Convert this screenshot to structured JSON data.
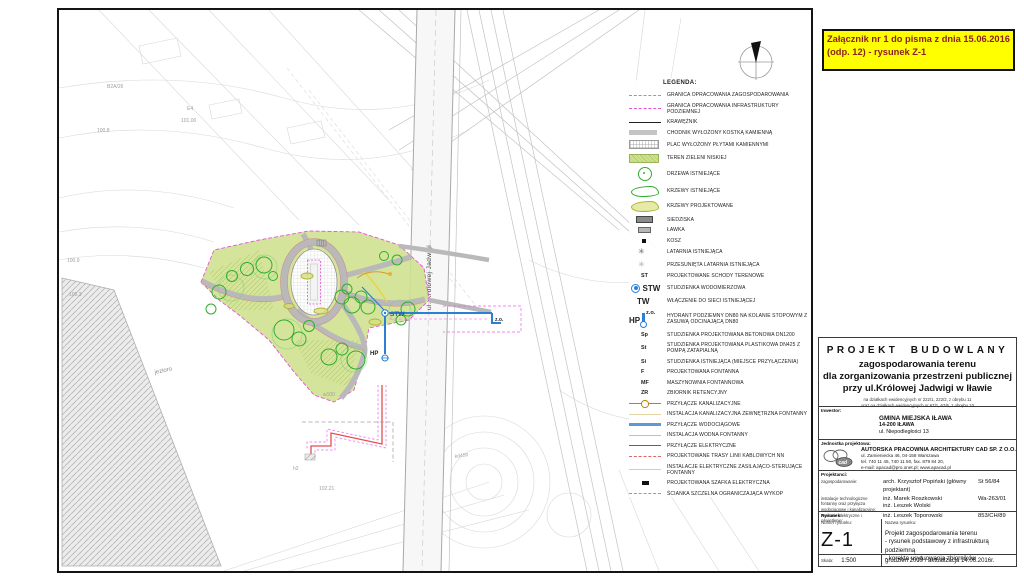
{
  "note": {
    "line1": "Załącznik nr 1 do pisma z dnia 15.06.2016",
    "line2": "(odp. 12) - rysunek Z-1"
  },
  "colors": {
    "note_bg": "#ffff00",
    "note_text": "#8b1e1e",
    "park_green": "#cfe08d",
    "boundary_magenta": "#e454d8",
    "water_blue": "#2b7fd4",
    "electric_red": "#e03030",
    "fountain_yellow": "#f1d738"
  },
  "map": {
    "road_label": "ul. Królowej Jadwigi",
    "lake_label": "jezioro",
    "markers": {
      "stw": "STW",
      "zo": "z.o.",
      "hp": "HP"
    },
    "labels": [
      "E4",
      "101.00",
      "B2A/26",
      "102.21",
      "h2",
      "w100",
      "kd450",
      "100.8",
      "100.3",
      "100.9"
    ]
  },
  "legend": {
    "title": "LEGENDA:",
    "items": [
      {
        "label": "GRANICA OPRACOWANIA ZAGOSPODAROWANIA"
      },
      {
        "label": "GRANICA OPRACOWANIA INFRASTRUKTURY PODZIEMNEJ"
      },
      {
        "label": "KRAWĘŻNIK"
      },
      {
        "label": "CHODNIK WYŁOŻONY KOSTKĄ KAMIENNĄ"
      },
      {
        "label": "PLAC WYŁOŻONY PŁYTAMI KAMIENNYMI"
      },
      {
        "label": "TEREN ZIELENI NISKIEJ"
      },
      {
        "label": "DRZEWA ISTNIEJĄCE"
      },
      {
        "label": "KRZEWY ISTNIEJĄCE"
      },
      {
        "label": "KRZEWY PROJEKTOWANE"
      },
      {
        "label": "SIEDZISKA"
      },
      {
        "label": "ŁAWKA"
      },
      {
        "label": "KOSZ"
      },
      {
        "label": "LATARNIA ISTNIEJĄCA"
      },
      {
        "label": "PRZESUNIĘTA LATARNIA ISTNIEJĄCA"
      },
      {
        "code": "ST",
        "label": "PROJEKTOWANE SCHODY TERENOWE"
      },
      {
        "code": "STW",
        "label": "STUDZIENKA WODOMIERZOWA"
      },
      {
        "code": "TW",
        "label": "WŁĄCZENIE DO SIECI ISTNIEJĄCEJ"
      },
      {
        "code": "HP",
        "code2": "z.o.",
        "label": "HYDRANT PODZIEMNY DN80 NA KOLANIE STOPOWYM Z ZASUWĄ ODCINAJĄCĄ DN80"
      },
      {
        "code": "Sp",
        "label": "STUDZIENKA PROJEKTOWANA BETONOWA DN1200"
      },
      {
        "code": "St",
        "label": "STUDZIENKA PROJEKTOWANA PLASTIKOWA DN425 Z POMPĄ ZATAPIALNĄ"
      },
      {
        "code": "Si",
        "label": "STUDZIENKA ISTNIEJĄCA (MIEJSCE PRZYŁĄCZENIA)"
      },
      {
        "code": "F",
        "label": "PROJEKTOWANA FONTANNA"
      },
      {
        "code": "MF",
        "label": "MASZYNOWNIA FONTANNOWA"
      },
      {
        "code": "ZR",
        "label": "ZBIORNIK RETENCYJNY"
      },
      {
        "label": "PRZYŁĄCZE KANALIZACYJNE"
      },
      {
        "label": "INSTALACJA KANALIZACYJNA ZEWNĘTRZNA FONTANNY"
      },
      {
        "label": "PRZYŁĄCZE WODOCIĄGOWE"
      },
      {
        "label": "INSTALACJA WODNA FONTANNY"
      },
      {
        "label": "PRZYŁĄCZE ELEKTRYCZNE"
      },
      {
        "label": "PROJEKTOWANE TRASY LINII KABLOWYCH NN"
      },
      {
        "label": "INSTALACJE ELEKTRYCZNE ZASILAJĄCO-STERUJĄCE FONTANNY"
      },
      {
        "label": "PROJEKTOWANA SZAFKA ELEKTRYCZNA"
      },
      {
        "label": "ŚCIANKA SZCZELNA OGRANICZAJĄCA WYKOP"
      }
    ]
  },
  "titleblock": {
    "project_type": "PROJEKT BUDOWLANY",
    "title1": "zagospodarowania terenu",
    "title2": "dla zorganizowania przestrzeni publicznej",
    "title3": "przy ul.Królowej Jadwigi w Iławie",
    "plots1": "na działkach ewidencyjnych nr 222/1, 222/2, z obrębu 11",
    "plots2": "oraz na działkach ewidencyjnych nr 67/1, 67/6, z obrębu 10",
    "inwestor_label": "Inwestor:",
    "inwestor_name": "GMINA MIEJSKA IŁAWA",
    "inwestor_zip": "14-200 IŁAWA",
    "inwestor_street": "ul. Niepodległości 13",
    "jednostka_label": "Jednostka projektowa:",
    "jednostka_name": "AUTORSKA PRACOWNIA ARCHITEKTURY CAD SP. Z O.O.",
    "jednostka_addr": "ul. Zamieniecka 46, 04-158 Warszawa",
    "jednostka_tel": "tel. 740 11 45, 740 11 50, fax. 879 84 20,",
    "jednostka_email": "e-mail: apacad@pro.onet.pl; www.apacad.pl",
    "projektanci_label": "Projektanci:",
    "rows": [
      {
        "role": "zagospodarowanie:",
        "name": "arch. Krzysztof Popiński (główny projektant)",
        "lic": "St 56/84",
        "name2": ""
      },
      {
        "role": "instalacje technologiczne fontanny oraz przyłącza wodociągowe i kanalizacyjne:",
        "name": "inż. Marek Roszkowski",
        "lic": "Wa-263/01",
        "name2": "inż. Leszek Wolski"
      },
      {
        "role": "zasilanie elektryczne i oświetlenie:",
        "name": "inż. Leszek Toporowski",
        "lic": "853/CH/89",
        "name2": ""
      }
    ],
    "rysunek_label": "Rysunek:",
    "numer_label": "Numer rysunku:",
    "nazwa_label": "Nazwa rysunku:",
    "number": "Z-1",
    "name1": "Projekt zagospodarowania terenu",
    "name2": "- rysunek podstawowy z infrastrukturą podziemną",
    "name3": "- korekta usytuowania zbiorników",
    "skala_label": "Skala:",
    "skala": "1:500",
    "date": "grudzień 2009 / aktualizacja 14.06.2016r."
  }
}
